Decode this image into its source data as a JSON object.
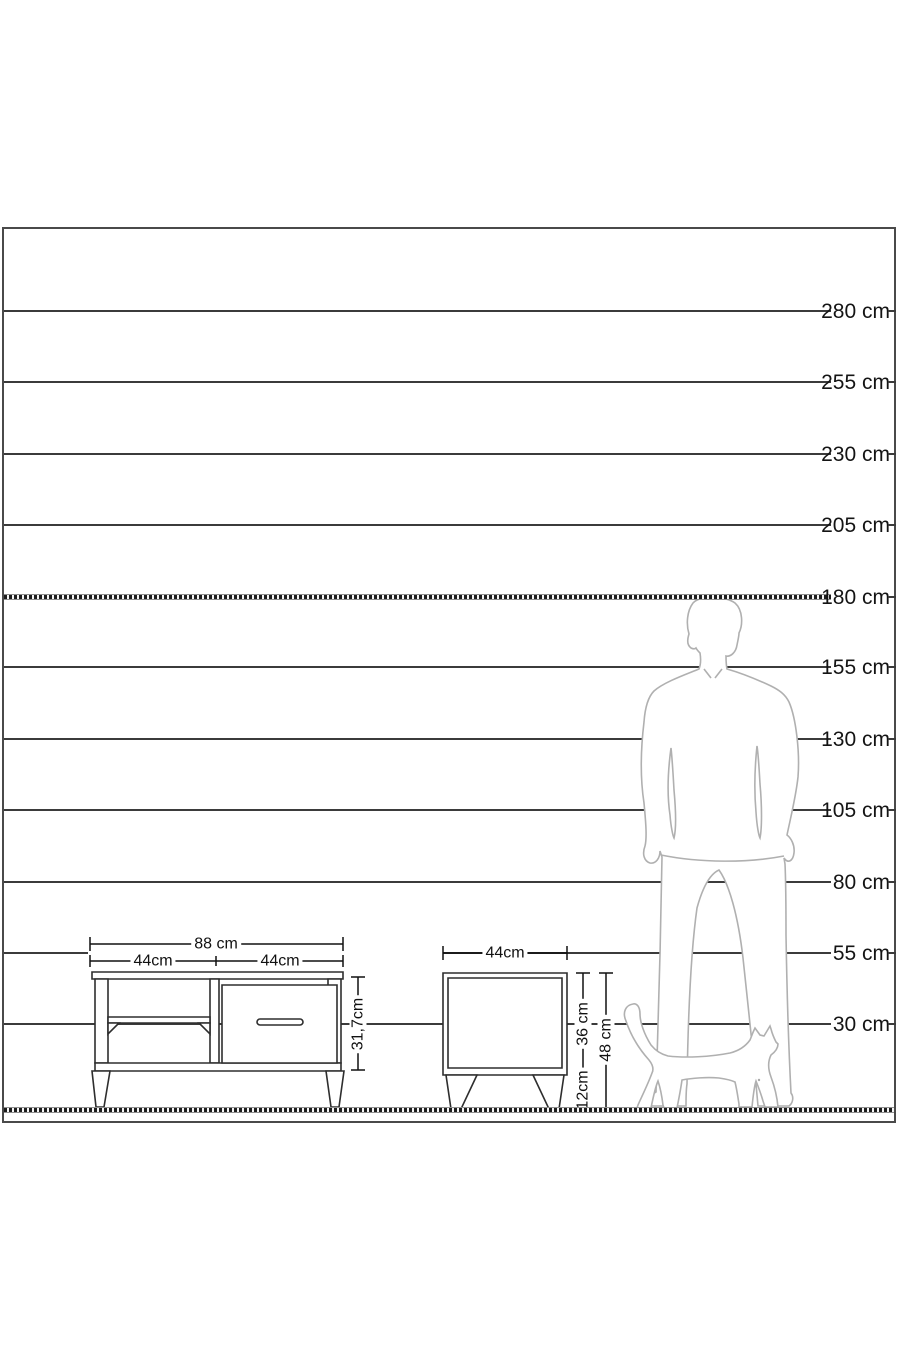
{
  "diagram": {
    "type": "furniture-size-comparison-diagram",
    "unit": "cm",
    "background": "#ffffff"
  },
  "colors": {
    "frame_border": "#4a4a4a",
    "ruler_line": "#3b3b3b",
    "dimension_line": "#111111",
    "silhouette_outline": "#b0b0b0",
    "text": "#141414"
  },
  "ruler": {
    "lines": [
      {
        "value": 280,
        "label": "280 cm",
        "style": "solid"
      },
      {
        "value": 255,
        "label": "255 cm",
        "style": "solid"
      },
      {
        "value": 230,
        "label": "230 cm",
        "style": "solid"
      },
      {
        "value": 205,
        "label": "205 cm",
        "style": "solid"
      },
      {
        "value": 180,
        "label": "180 cm",
        "style": "dotted"
      },
      {
        "value": 155,
        "label": "155 cm",
        "style": "solid"
      },
      {
        "value": 130,
        "label": "130 cm",
        "style": "solid"
      },
      {
        "value": 105,
        "label": "105 cm",
        "style": "solid"
      },
      {
        "value": 80,
        "label": "80 cm",
        "style": "solid"
      },
      {
        "value": 55,
        "label": "55 cm",
        "style": "solid"
      },
      {
        "value": 30,
        "label": "30 cm",
        "style": "solid"
      }
    ],
    "ground": {
      "value": 0,
      "style": "dotted"
    }
  },
  "furniture": {
    "tv_stand": {
      "width": "88 cm",
      "section_widths": [
        "44cm",
        "44cm"
      ],
      "body_height": "31,7cm"
    },
    "nightstand": {
      "width": "44cm",
      "body_height": "36 cm",
      "leg_height": "12cm",
      "total_height": "48 cm"
    }
  },
  "icons": {
    "man": "man-silhouette",
    "cat": "cat-silhouette"
  }
}
